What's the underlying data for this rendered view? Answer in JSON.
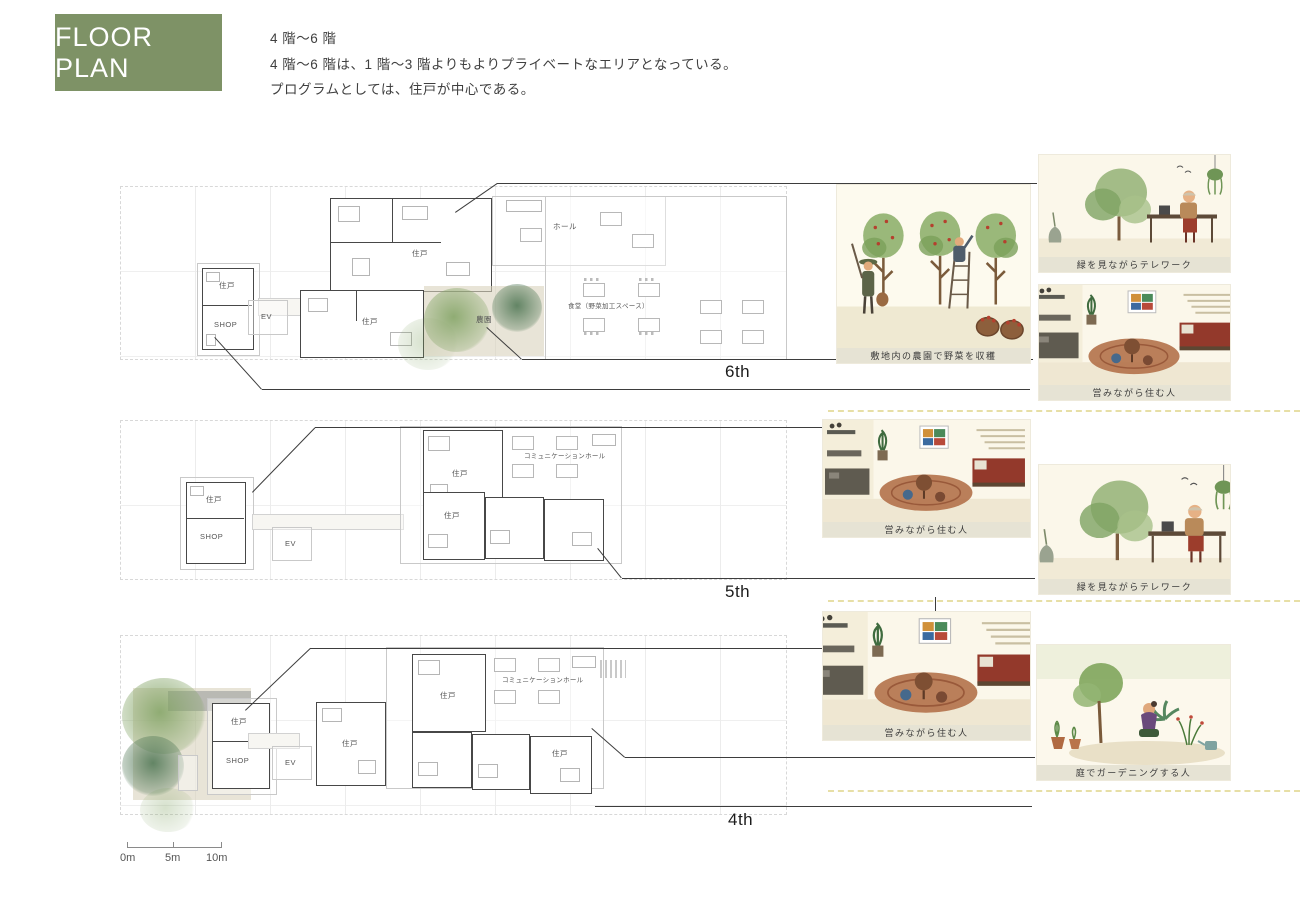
{
  "header": {
    "title": "FLOOR PLAN",
    "floor_range": "4 階〜6 階",
    "description_1": "4 階〜6 階は、1 階〜3 階よりもよりプライベートなエリアとなっている。",
    "description_2": "プログラムとしては、住戸が中心である。",
    "accent_color": "#7e9266"
  },
  "floors": [
    {
      "label": "6th"
    },
    {
      "label": "5th"
    },
    {
      "label": "4th"
    }
  ],
  "plan_labels": {
    "unit": "住戸",
    "shop": "SHOP",
    "elevator": "EV",
    "hall": "ホール",
    "farm": "農園",
    "dining": "食堂（野菜加工スペース）",
    "communication_hall": "コミュニケーションホール"
  },
  "illustrations": {
    "harvest": {
      "caption": "敷地内の農園で野菜を収穫"
    },
    "telework_1": {
      "caption": "緑を見ながらテレワーク"
    },
    "living_1": {
      "caption": "営みながら住む人"
    },
    "living_2": {
      "caption": "営みながら住む人"
    },
    "telework_2": {
      "caption": "緑を見ながらテレワーク"
    },
    "living_3": {
      "caption": "営みながら住む人"
    },
    "gardening": {
      "caption": "庭でガーデニングする人"
    }
  },
  "scale_bar": {
    "labels": [
      "0m",
      "5m",
      "10m"
    ]
  }
}
